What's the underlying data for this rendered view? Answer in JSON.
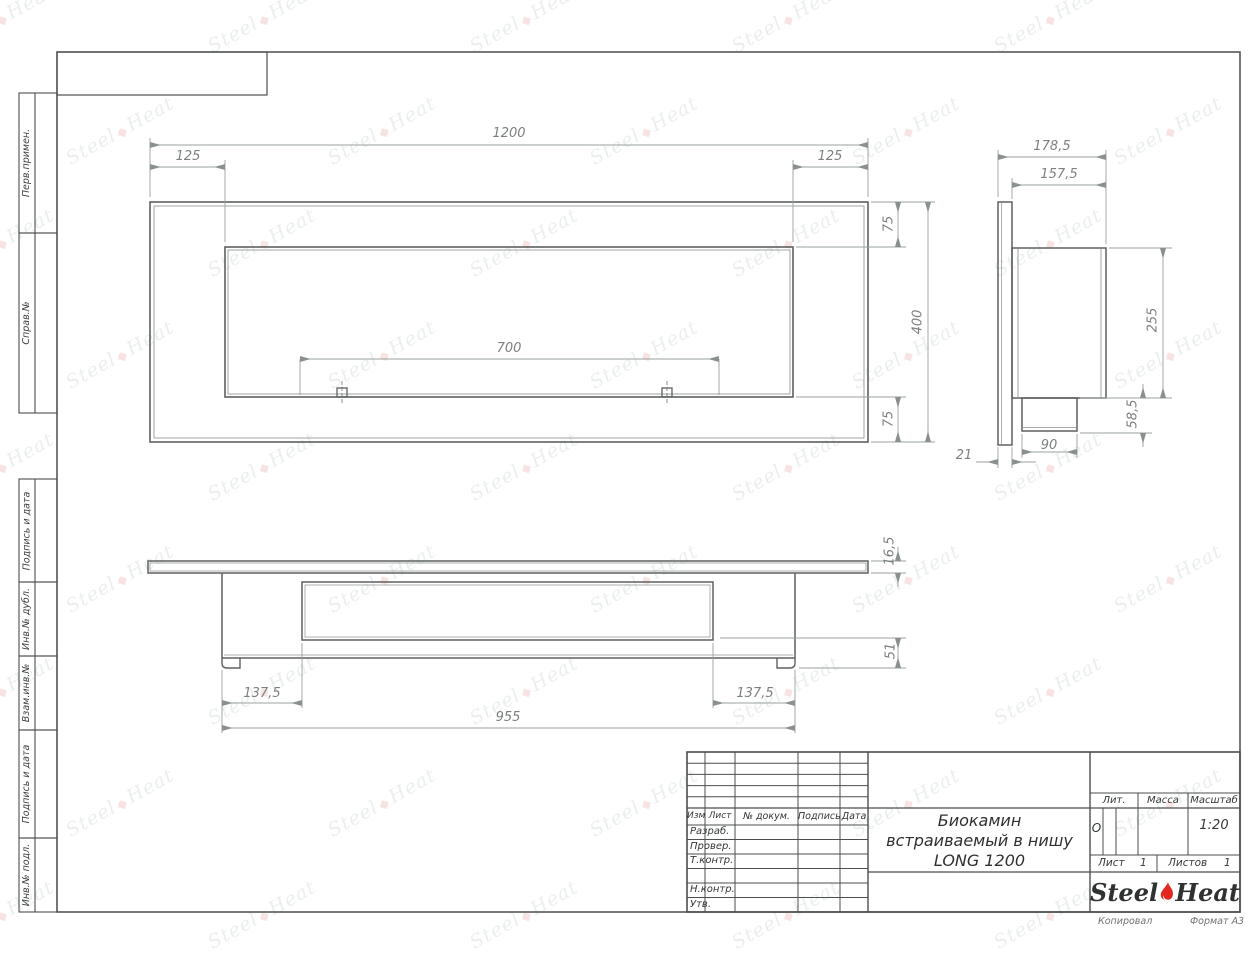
{
  "frame": {
    "left_labels": [
      "Перв.примен.",
      "Справ.№",
      "Подпись и дата",
      "Инв.№ дубл.",
      "Взам.инв.№",
      "Подпись и дата",
      "Инв.№ подл."
    ],
    "footer_copied": "Копировал",
    "footer_format": "Формат А3"
  },
  "title_block": {
    "cols": {
      "izm": "Изм.",
      "list": "Лист",
      "doc": "№ докум.",
      "sign": "Подпись",
      "date": "Дата"
    },
    "rows": {
      "dev": "Разраб.",
      "check": "Провер.",
      "tcontr": "Т.контр.",
      "ncontr": "Н.контр.",
      "approve": "Утв."
    },
    "title_line1": "Биокамин",
    "title_line2": "встраиваемый в нишу",
    "title_line3": "LONG 1200",
    "lit_label": "Лит.",
    "lit_value": "О",
    "mass_label": "Масса",
    "scale_label": "Масштаб",
    "scale_value": "1:20",
    "sheet_label": "Лист",
    "sheet_num": "1",
    "sheets_label": "Листов",
    "sheets_num": "1",
    "logo_steel": "Steel",
    "logo_heat": "Heat"
  },
  "watermark": {
    "steel": "Steel",
    "heat": "Heat"
  },
  "dims": {
    "front_width": "1200",
    "front_inset_left": "125",
    "front_inset_right": "125",
    "front_burner": "700",
    "front_top": "75",
    "front_height": "400",
    "front_bottom": "75",
    "side_depth_total": "178,5",
    "side_depth_body": "157,5",
    "side_body_height": "255",
    "side_tray_height": "58,5",
    "side_tray_width": "90",
    "side_flange": "21",
    "bottom_flange": "16,5",
    "bottom_body": "51",
    "bottom_inset_left": "137,5",
    "bottom_inset_right": "137,5",
    "bottom_body_width": "955"
  }
}
